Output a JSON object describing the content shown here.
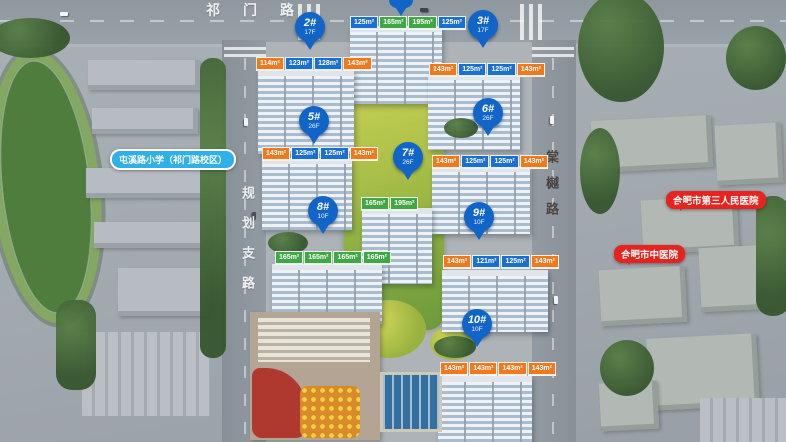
{
  "roads": {
    "top": "祁门路",
    "left": "规划支路",
    "right": "棠樾路"
  },
  "pois": {
    "school": {
      "label": "屯溪路小学（祁门路校区）",
      "color": "#2fb0e8"
    },
    "hospital_1": {
      "label": "合肥市第三人民医院",
      "color": "#e6231e"
    },
    "hospital_2": {
      "label": "合肥市中医院",
      "color": "#e6231e"
    }
  },
  "pins": [
    {
      "id": "2#",
      "floors": "17F"
    },
    {
      "id": "3#",
      "floors": "17F"
    },
    {
      "id": "5#",
      "floors": "26F"
    },
    {
      "id": "6#",
      "floors": "26F"
    },
    {
      "id": "7#",
      "floors": "26F"
    },
    {
      "id": "8#",
      "floors": "10F"
    },
    {
      "id": "9#",
      "floors": "10F"
    },
    {
      "id": "10#",
      "floors": "10F"
    }
  ],
  "unit_tag_rows": [
    {
      "building": "north-tower",
      "tags": [
        {
          "t": "125m²",
          "c": "blue"
        },
        {
          "t": "165m²",
          "c": "green"
        },
        {
          "t": "195m²",
          "c": "green"
        },
        {
          "t": "125m²",
          "c": "blue"
        }
      ]
    },
    {
      "building": "2#",
      "tags": [
        {
          "t": "114m²",
          "c": "orange"
        },
        {
          "t": "123m²",
          "c": "blue"
        },
        {
          "t": "128m²",
          "c": "blue"
        },
        {
          "t": "143m²",
          "c": "orange"
        }
      ]
    },
    {
      "building": "3#",
      "tags": [
        {
          "t": "143m²",
          "c": "orange"
        },
        {
          "t": "125m²",
          "c": "blue"
        },
        {
          "t": "125m²",
          "c": "blue"
        },
        {
          "t": "143m²",
          "c": "orange"
        }
      ]
    },
    {
      "building": "5#",
      "tags": [
        {
          "t": "143m²",
          "c": "orange"
        },
        {
          "t": "125m²",
          "c": "blue"
        },
        {
          "t": "125m²",
          "c": "blue"
        },
        {
          "t": "143m²",
          "c": "orange"
        }
      ]
    },
    {
      "building": "6#",
      "tags": [
        {
          "t": "143m²",
          "c": "orange"
        },
        {
          "t": "125m²",
          "c": "blue"
        },
        {
          "t": "125m²",
          "c": "blue"
        },
        {
          "t": "143m²",
          "c": "orange"
        }
      ]
    },
    {
      "building": "7#",
      "tags": [
        {
          "t": "165m²",
          "c": "green"
        },
        {
          "t": "195m²",
          "c": "green"
        }
      ]
    },
    {
      "building": "8#",
      "tags": [
        {
          "t": "165m²",
          "c": "green"
        },
        {
          "t": "165m²",
          "c": "green"
        },
        {
          "t": "165m²",
          "c": "green"
        },
        {
          "t": "165m²",
          "c": "green"
        }
      ]
    },
    {
      "building": "9#",
      "tags": [
        {
          "t": "143m²",
          "c": "orange"
        },
        {
          "t": "121m²",
          "c": "blue"
        },
        {
          "t": "125m²",
          "c": "blue"
        },
        {
          "t": "143m²",
          "c": "orange"
        }
      ]
    },
    {
      "building": "10#",
      "tags": [
        {
          "t": "143m²",
          "c": "orange"
        },
        {
          "t": "143m²",
          "c": "orange"
        },
        {
          "t": "143m²",
          "c": "orange"
        },
        {
          "t": "143m²",
          "c": "orange"
        }
      ]
    }
  ],
  "colors": {
    "pin": "#1164c8",
    "tag_blue": "#1a6fd0",
    "tag_orange": "#f0791d",
    "tag_green": "#3fa844",
    "school_bubble": "#2fb0e8",
    "hospital_bubble": "#e6231e"
  }
}
